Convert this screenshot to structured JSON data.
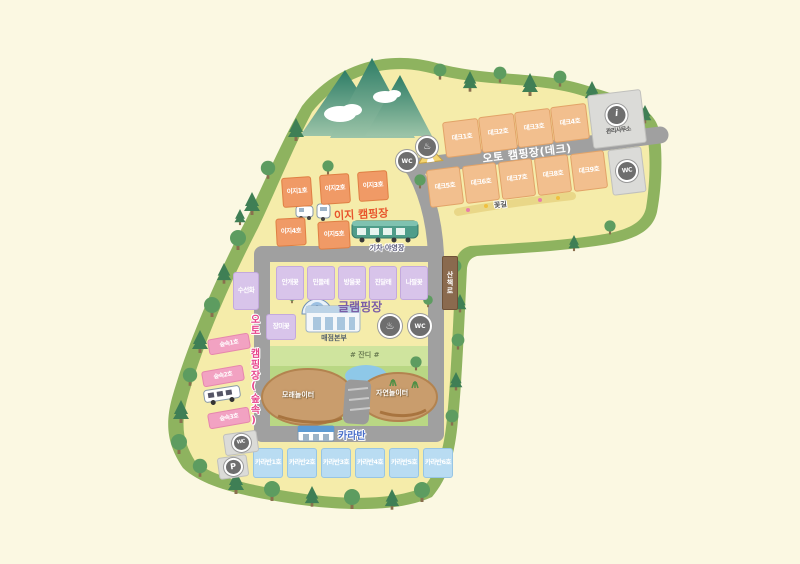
{
  "deck_zone": {
    "banner": "오토 캠핑장(데크)",
    "row1": [
      "데크1호",
      "데크2호",
      "데크3호",
      "데크4호"
    ],
    "row2": [
      "데크5호",
      "데크6호",
      "데크7호",
      "데크8호",
      "데크9호"
    ],
    "office": "관리사무소"
  },
  "easy_zone": {
    "title": "이지 캠핑장",
    "row1": [
      "이지1호",
      "이지2호",
      "이지3호"
    ],
    "row2": [
      "이지4호",
      "이지5호"
    ],
    "train_label": "기차 야영장"
  },
  "glamping_zone": {
    "title": "글램핑장",
    "sites": [
      "안개꽃",
      "민들레",
      "방울꽃",
      "진달래",
      "나팔꽃"
    ],
    "side_site": "수선화",
    "lower_site": "장미꽃",
    "store": "매점본부"
  },
  "park": {
    "lawn": "# 잔디 #",
    "left_playground": "모래놀이터",
    "right_playground": "자연놀이터"
  },
  "caravan_zone": {
    "title": "카라반",
    "sites": [
      "카라반1호",
      "카라반2호",
      "카라반3호",
      "카라반4호",
      "카라반5호",
      "카라반6호"
    ]
  },
  "forest_zone": {
    "banner": "오토 캠핑장(숲속)",
    "sites": [
      "숲속1호",
      "숲속2호",
      "숲속3호"
    ]
  },
  "signs": {
    "trail": "산책로",
    "flower_path": "꽃길"
  },
  "icons": {
    "restroom": "WC",
    "shower": "♨",
    "parking": "P",
    "info": "i"
  },
  "colors": {
    "easy_title": "#e8542c",
    "glamping_title": "#7b5ea7",
    "caravan_title": "#4a6fc9",
    "forest_banner": "#e8468c",
    "map_border": "#8eb35f",
    "field": "#f5ecaa",
    "road": "#a0a0a0"
  }
}
